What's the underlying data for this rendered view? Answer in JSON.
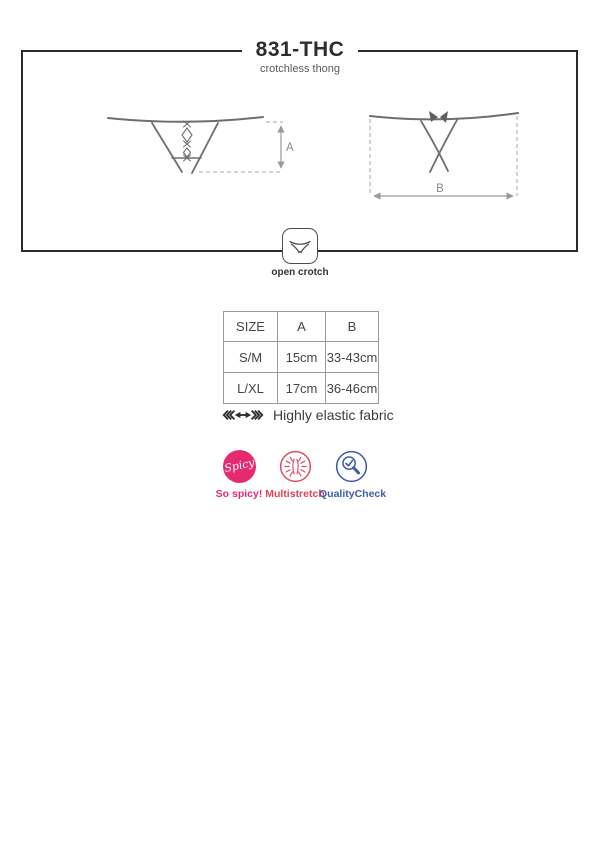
{
  "header": {
    "title": "831-THC",
    "subtitle": "crotchless thong"
  },
  "diagram": {
    "front_measure_label": "A",
    "back_measure_label": "B",
    "open_crotch_label": "open crotch"
  },
  "size_table": {
    "headers": [
      "SIZE",
      "A",
      "B"
    ],
    "rows": [
      {
        "size": "S/M",
        "a": "15cm",
        "b": "33-43cm"
      },
      {
        "size": "L/XL",
        "a": "17cm",
        "b": "36-46cm"
      }
    ]
  },
  "fabric_note": {
    "label": "Highly elastic fabric"
  },
  "badges": {
    "spicy": {
      "icon_text": "Spicy",
      "label": "So spicy!",
      "color": "#e62a72"
    },
    "multistretch": {
      "label": "Multistretch",
      "color": "#dc4f68"
    },
    "quality_check": {
      "label": "QualityCheck",
      "color": "#3f5ca9"
    }
  },
  "colors": {
    "frame_border": "#2b2b2b",
    "drawing_stroke": "#6e6e6e",
    "dashed_line": "#b8b8b8",
    "measure_arrow": "#9a9a9a",
    "table_border": "#9b9b9b"
  }
}
